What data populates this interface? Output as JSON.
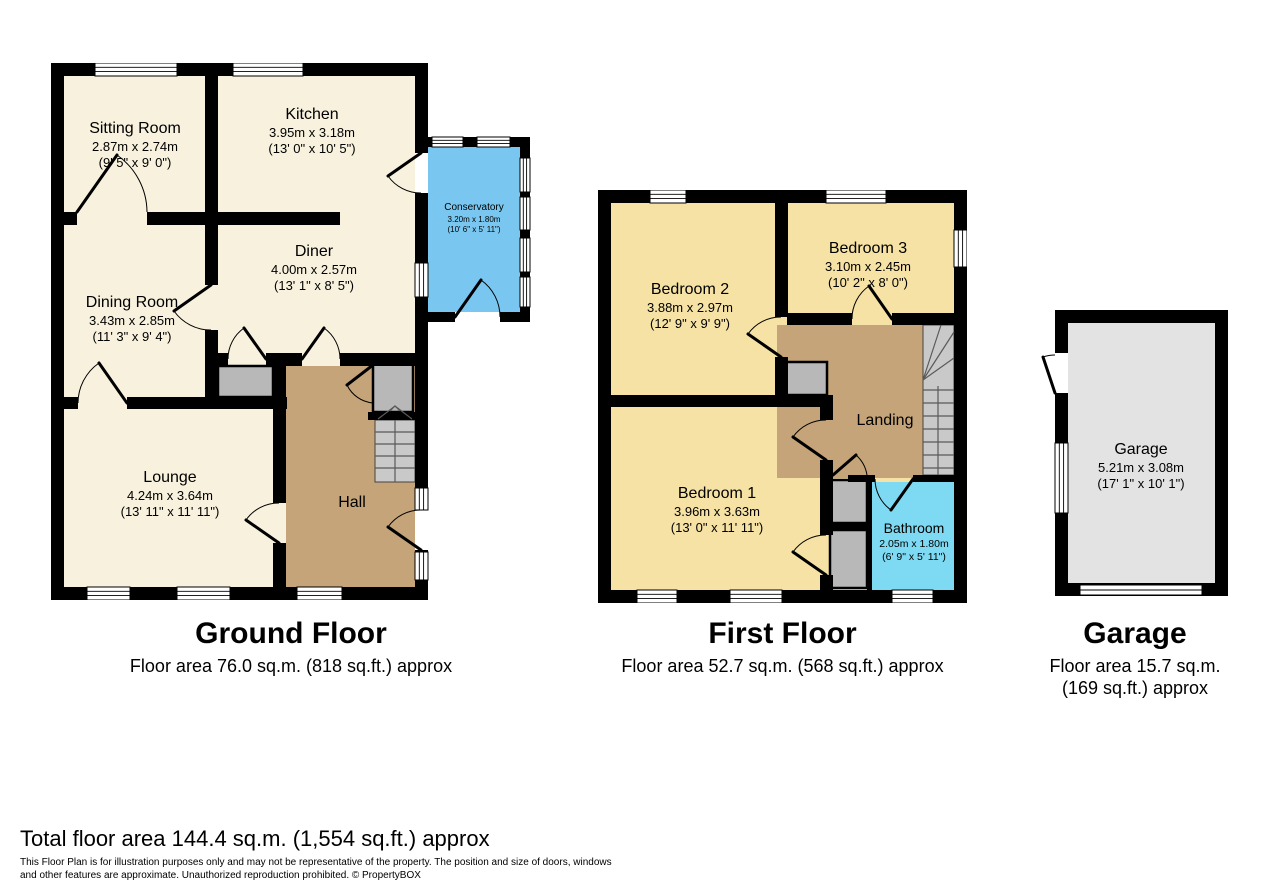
{
  "floors": {
    "ground": {
      "title": "Ground Floor",
      "area": "Floor area 76.0 sq.m. (818 sq.ft.) approx",
      "rooms": {
        "sitting_room": {
          "name": "Sitting Room",
          "metric": "2.87m x 2.74m",
          "imperial": "(9' 5\" x 9' 0\")"
        },
        "kitchen": {
          "name": "Kitchen",
          "metric": "3.95m x 3.18m",
          "imperial": "(13' 0\" x 10' 5\")"
        },
        "dining_room": {
          "name": "Dining Room",
          "metric": "3.43m x 2.85m",
          "imperial": "(11' 3\" x 9' 4\")"
        },
        "diner": {
          "name": "Diner",
          "metric": "4.00m x 2.57m",
          "imperial": "(13' 1\" x 8' 5\")"
        },
        "lounge": {
          "name": "Lounge",
          "metric": "4.24m x 3.64m",
          "imperial": "(13' 11\" x 11' 11\")"
        },
        "hall": {
          "name": "Hall"
        },
        "conservatory": {
          "name": "Conservatory",
          "metric": "3.20m x 1.80m",
          "imperial": "(10' 6\" x 5' 11\")"
        }
      }
    },
    "first": {
      "title": "First Floor",
      "area": "Floor area 52.7 sq.m. (568 sq.ft.) approx",
      "rooms": {
        "bedroom1": {
          "name": "Bedroom 1",
          "metric": "3.96m x 3.63m",
          "imperial": "(13' 0\" x 11' 11\")"
        },
        "bedroom2": {
          "name": "Bedroom 2",
          "metric": "3.88m x 2.97m",
          "imperial": "(12' 9\" x 9' 9\")"
        },
        "bedroom3": {
          "name": "Bedroom 3",
          "metric": "3.10m x 2.45m",
          "imperial": "(10' 2\" x 8' 0\")"
        },
        "landing": {
          "name": "Landing"
        },
        "bathroom": {
          "name": "Bathroom",
          "metric": "2.05m x 1.80m",
          "imperial": "(6' 9\" x 5' 11\")"
        }
      }
    },
    "garage": {
      "title": "Garage",
      "area_line1": "Floor area 15.7 sq.m.",
      "area_line2": "(169 sq.ft.) approx",
      "rooms": {
        "garage": {
          "name": "Garage",
          "metric": "5.21m x 3.08m",
          "imperial": "(17' 1\" x 10' 1\")"
        }
      }
    }
  },
  "footer": {
    "total": "Total floor area 144.4 sq.m. (1,554 sq.ft.) approx",
    "disclaimer_line1": "This Floor Plan is for illustration purposes only and may not be representative of the property. The position and size of doors, windows",
    "disclaimer_line2": "and other features are approximate. Unauthorized reproduction prohibited. © PropertyBOX"
  },
  "colors": {
    "wall": "#000000",
    "ground_room": "#F7F1DE",
    "first_room": "#F5E2A4",
    "hall": "#C4A478",
    "conservatory": "#79C7F0",
    "bathroom": "#7EDAF2",
    "cupboard": "#B8B8B8",
    "stairs": "#C9C9C9",
    "garage_floor": "#E3E3E3"
  }
}
